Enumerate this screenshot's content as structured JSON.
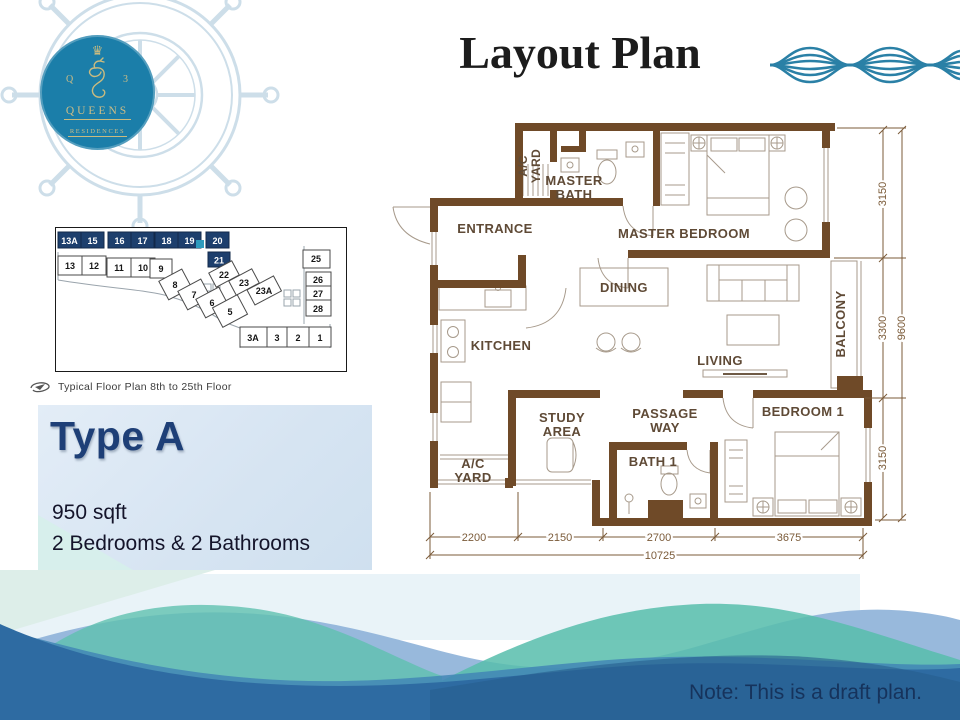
{
  "header": {
    "title": "Layout Plan"
  },
  "logo": {
    "crown": "♛",
    "monogram_left": "Q",
    "monogram_right": "3",
    "name": "QUEENS",
    "subtitle": "RESIDENCES"
  },
  "siteplan": {
    "caption": "Typical Floor Plan 8th to 25th Floor",
    "highlighted_units": [
      "13A",
      "15",
      "16",
      "17",
      "18",
      "19",
      "20",
      "21"
    ],
    "units": [
      "13",
      "12",
      "11",
      "10",
      "9",
      "8",
      "7",
      "6",
      "5",
      "22",
      "23",
      "23A",
      "25",
      "26",
      "27",
      "28",
      "3A",
      "3",
      "2",
      "1"
    ]
  },
  "unit_info": {
    "type": "Type A",
    "area": "950 sqft",
    "config": "2 Bedrooms & 2 Bathrooms"
  },
  "floorplan": {
    "rooms": {
      "ac_top_1": "A/C",
      "ac_top_2": "YARD",
      "master_bath_1": "MASTER",
      "master_bath_2": "BATH",
      "master_bedroom": "MASTER BEDROOM",
      "entrance": "ENTRANCE",
      "dining": "DINING",
      "kitchen": "KITCHEN",
      "living": "LIVING",
      "balcony": "BALCONY",
      "study_1": "STUDY",
      "study_2": "AREA",
      "passage_1": "PASSAGE",
      "passage_2": "WAY",
      "bedroom1": "BEDROOM 1",
      "bath1": "BATH 1",
      "ac_bottom_1": "A/C",
      "ac_bottom_2": "YARD"
    },
    "dims_vertical": [
      "3150",
      "3300",
      "3150"
    ],
    "dims_vertical_total": "9600",
    "dims_horizontal": [
      "2200",
      "2150",
      "2700",
      "3675"
    ],
    "dims_horizontal_total": "10725"
  },
  "note": {
    "text": "Note: This is a draft plan."
  },
  "colors": {
    "logo_teal": "#1b7ea9",
    "navy": "#1d3f6d",
    "wall_brown": "#6f4a28",
    "wave_blue": "#2e6ba2",
    "wave_teal": "#5fc0af"
  }
}
